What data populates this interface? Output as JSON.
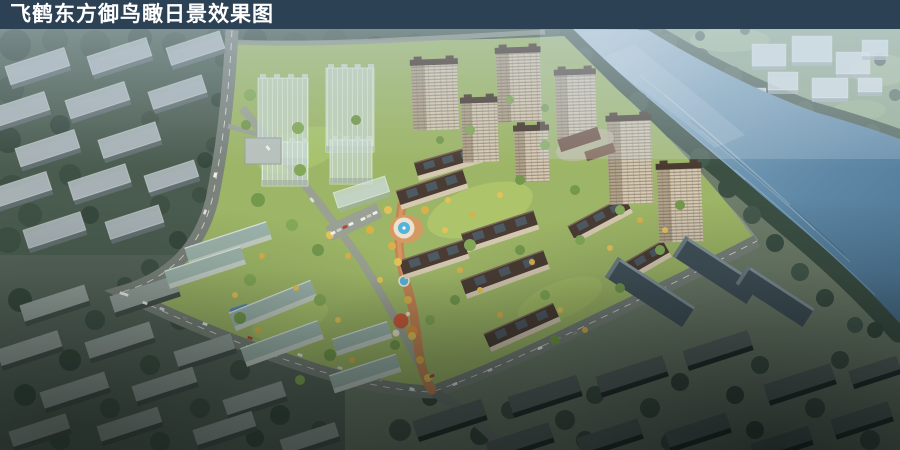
{
  "title_bar": {
    "text": "飞鹤东方御鸟瞰日景效果图",
    "background": "#2c4154",
    "text_color": "#ffffff"
  },
  "scene": {
    "kind": "aerial-daytime-architectural-rendering",
    "elements": [
      "river",
      "riverside-trees",
      "far-bank-fields",
      "future-massing-cubes",
      "context-massing-blocks",
      "residential-towers",
      "midrise-slab-rows",
      "glass-massing-towers",
      "central-landscape-axis",
      "round-fountain-plaza",
      "small-pool",
      "playground",
      "perimeter-roads",
      "cars",
      "bus",
      "parking-row",
      "dark-context-towers"
    ],
    "palette": {
      "title_bar": "#2c4154",
      "river_deep": "#4c7492",
      "river_mid": "#5d87a5",
      "river_haze": "#b4c9d6",
      "far_fields": "#93ab8c",
      "forest": "#3e5045",
      "site_lawn": "#9db566",
      "building_wall": "#d6c9b2",
      "building_roof": "#4a3c33",
      "teal_roof": "#9cb3ab",
      "glass_massing": "#c8d6cc",
      "context_slab_top": "#b0bbbe",
      "dark_tower": "#42525a",
      "plaza_paving": "#c58455",
      "fountain_water": "#55b2d8",
      "road": "#7a827b",
      "tree_gold": "#d8b14a"
    }
  }
}
